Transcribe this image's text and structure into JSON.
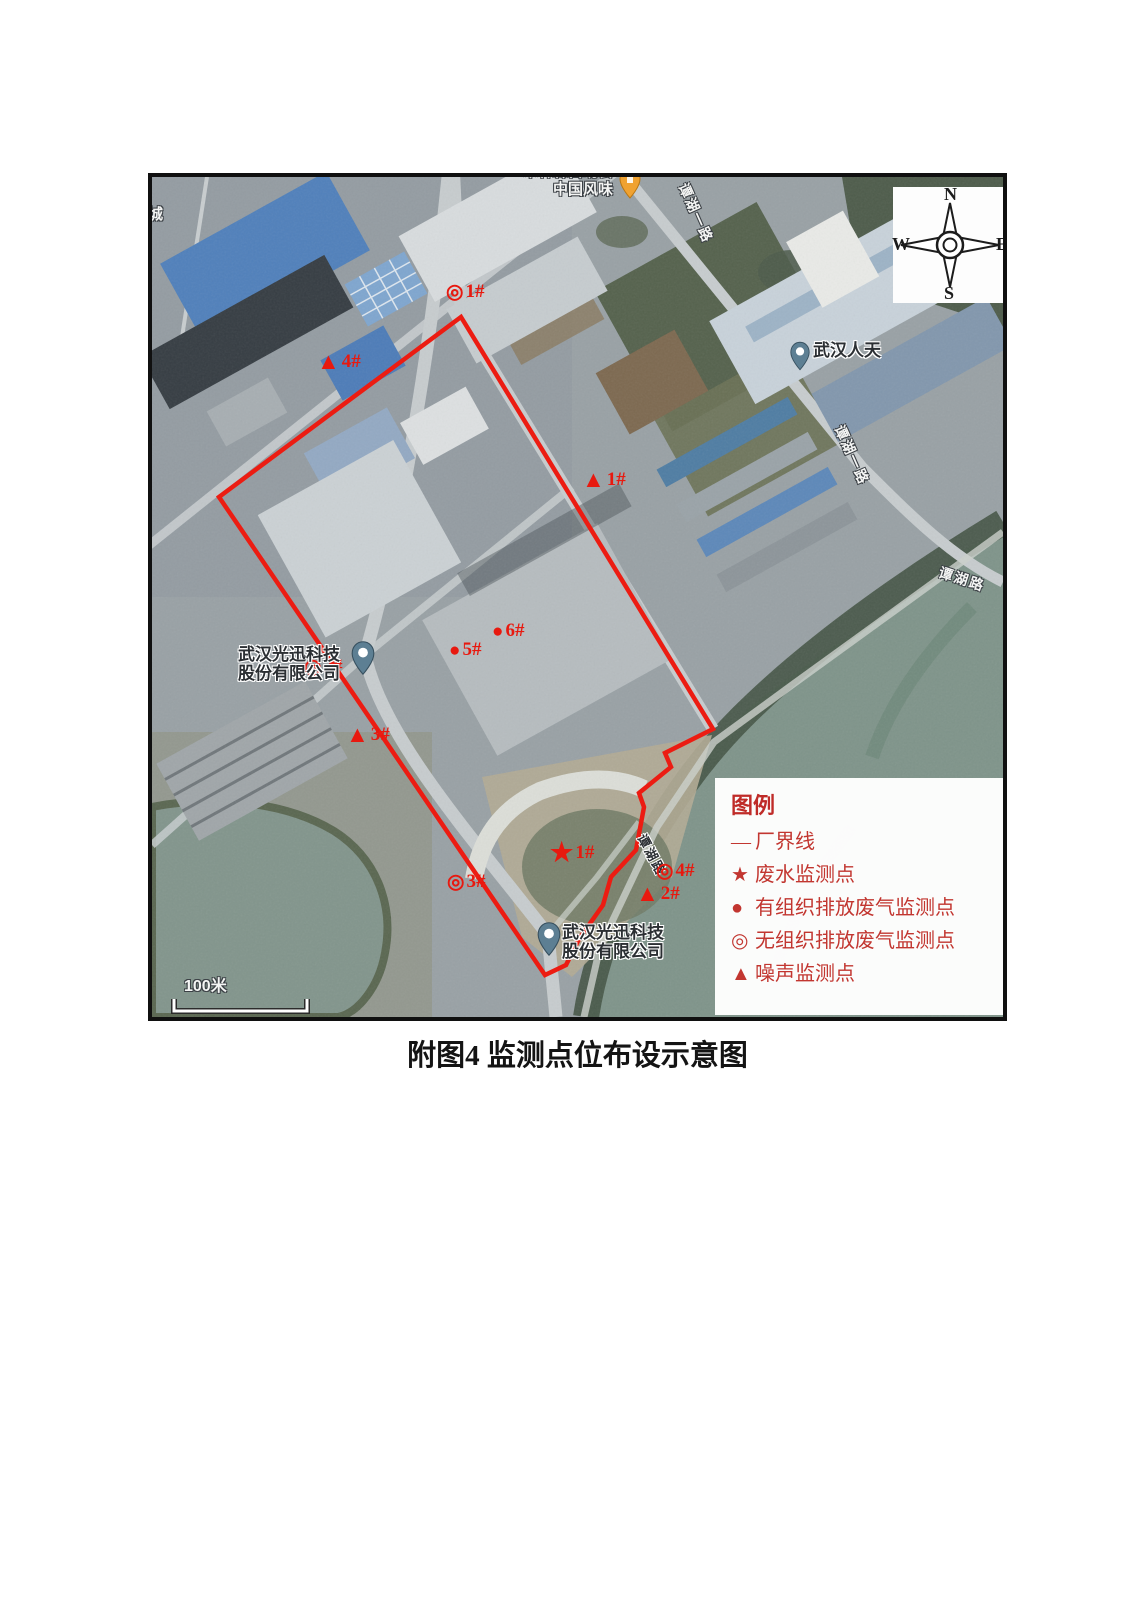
{
  "figure": {
    "caption": "附图4 监测点位布设示意图"
  },
  "compass": {
    "n": "N",
    "s": "S",
    "e": "E",
    "w": "W"
  },
  "legend": {
    "title": "图例",
    "items": [
      {
        "symbol": "—",
        "label": "厂界线"
      },
      {
        "symbol": "★",
        "label": "废水监测点"
      },
      {
        "symbol": "●",
        "label": "有组织排放废气监测点"
      },
      {
        "symbol": "◎",
        "label": "无组织排放废气监测点"
      },
      {
        "symbol": "▲",
        "label": "噪声监测点"
      }
    ]
  },
  "markers": [
    {
      "symbol": "◎",
      "label": "1#",
      "type": "unorganized-gas"
    },
    {
      "symbol": "▲",
      "label": "4#",
      "type": "noise"
    },
    {
      "symbol": "▲",
      "label": "1#",
      "type": "noise"
    },
    {
      "symbol": "●",
      "label": "6#",
      "type": "organized-gas"
    },
    {
      "symbol": "●",
      "label": "5#",
      "type": "organized-gas"
    },
    {
      "symbol": "◎",
      "label": "2#",
      "type": "unorganized-gas"
    },
    {
      "symbol": "▲",
      "label": "3#",
      "type": "noise"
    },
    {
      "symbol": "★",
      "label": "1#",
      "type": "wastewater"
    },
    {
      "symbol": "◎",
      "label": "3#",
      "type": "unorganized-gas"
    },
    {
      "symbol": "◎",
      "label": "4#",
      "type": "unorganized-gas"
    },
    {
      "symbol": "▲",
      "label": "2#",
      "type": "noise"
    }
  ],
  "map_labels": {
    "restaurant_line1": "木林森自助餐",
    "restaurant_line2": "中国风味",
    "poi_rentian": "武汉人天",
    "guangxun1_line1": "武汉光迅科技",
    "guangxun1_line2": "股份有限公司",
    "guangxun2_line1": "武汉光迅科技",
    "guangxun2_line2": "股份有限公司",
    "road_tanhu_yilu_top": "谭湖一路",
    "road_tanhu_yilu_mid": "谭湖一路",
    "road_tanhu_lu_east": "谭湖路",
    "road_tanhu_lu_south": "谭湖路",
    "edge_partial_char": "城"
  },
  "scale_bar": {
    "label": "100米"
  },
  "colors": {
    "boundary_red": "#EC1C12",
    "marker_red": "#E8190F",
    "legend_text": "#C23630",
    "water": "#7F948A",
    "vegetation": "#49584A"
  }
}
